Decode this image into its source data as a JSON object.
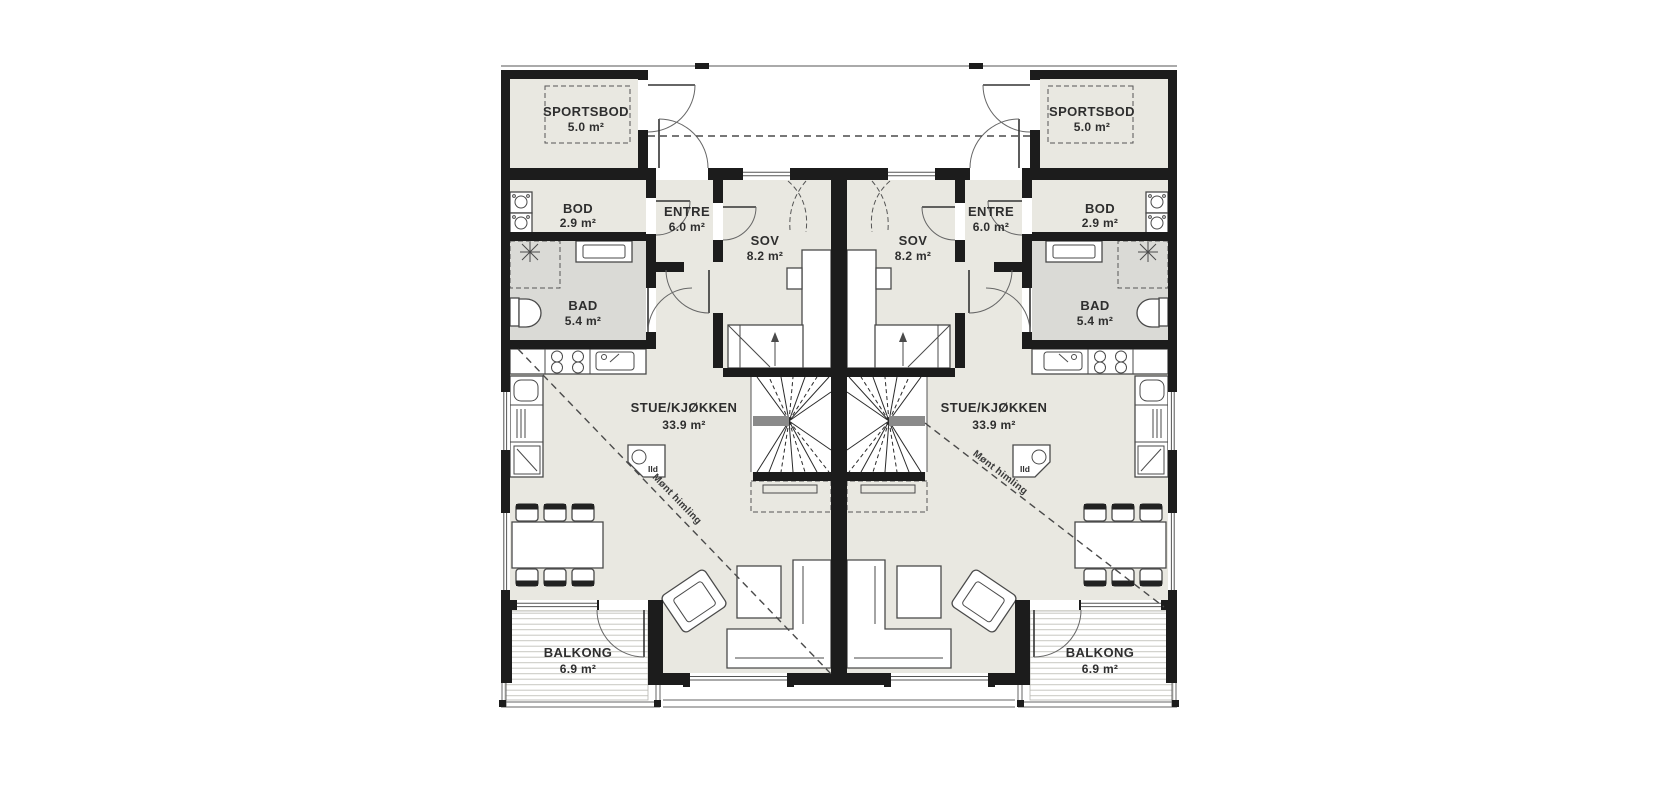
{
  "document_type": "apartment floor plan, two mirrored units",
  "rooms": {
    "sportsbod": {
      "name": "SPORTSBOD",
      "area": "5.0 m²"
    },
    "bod": {
      "name": "BOD",
      "area": "2.9 m²"
    },
    "entre": {
      "name": "ENTRE",
      "area": "6.0 m²"
    },
    "sov": {
      "name": "SOV",
      "area": "8.2 m²"
    },
    "bad": {
      "name": "BAD",
      "area": "5.4 m²"
    },
    "stue_kjokken": {
      "name": "STUE/KJØKKEN",
      "area": "33.9 m²"
    },
    "balkong": {
      "name": "BALKONG",
      "area": "6.9 m²"
    }
  },
  "annotations": {
    "fireplace_label": "Ild",
    "ceiling_note": "Mønt himling"
  },
  "units": [
    {
      "side": "left"
    },
    {
      "side": "right"
    }
  ],
  "colors": {
    "background": "#ffffff",
    "wall": "#1c1c1c",
    "floor": "#e9e8e1",
    "bathroom_floor": "#dadad6",
    "balcony_deck_line": "#c8c8c2",
    "stair_landing": "#8a8a8a",
    "outline": "#4a4a4a",
    "text": "#2e2e2e"
  }
}
